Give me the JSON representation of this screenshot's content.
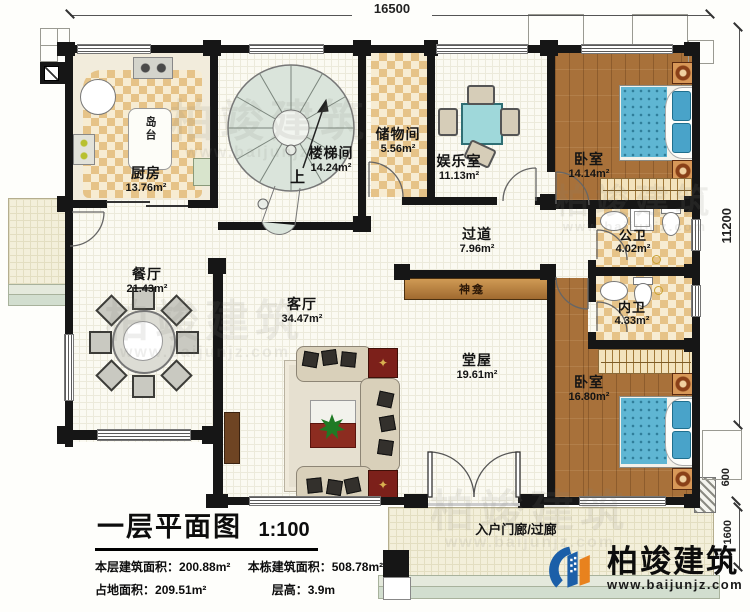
{
  "plan": {
    "dimensions": {
      "top_width": "16500",
      "right_height": "11200",
      "right_offset": "600",
      "porch_depth": "1600"
    },
    "rooms": [
      {
        "id": "kitchen",
        "name": "厨房",
        "area": "13.76m²"
      },
      {
        "id": "island",
        "name": "岛台",
        "area": ""
      },
      {
        "id": "stairwell",
        "name": "楼梯间",
        "area": "14.24m²",
        "up": "上"
      },
      {
        "id": "storage",
        "name": "储物间",
        "area": "5.56m²"
      },
      {
        "id": "entertainment",
        "name": "娱乐室",
        "area": "11.13m²"
      },
      {
        "id": "bedroom1",
        "name": "卧室",
        "area": "14.14m²"
      },
      {
        "id": "public-bath",
        "name": "公卫",
        "area": "4.02m²"
      },
      {
        "id": "hallway",
        "name": "过道",
        "area": "7.96m²"
      },
      {
        "id": "shrine",
        "name": "神龛",
        "area": ""
      },
      {
        "id": "ensuite-bath",
        "name": "内卫",
        "area": "4.33m²"
      },
      {
        "id": "dining",
        "name": "餐厅",
        "area": "21.43m²"
      },
      {
        "id": "living",
        "name": "客厅",
        "area": "34.47m²"
      },
      {
        "id": "main-hall",
        "name": "堂屋",
        "area": "19.61m²"
      },
      {
        "id": "bedroom2",
        "name": "卧室",
        "area": "16.80m²"
      },
      {
        "id": "porch",
        "name": "入户门廊/过廊",
        "area": ""
      }
    ]
  },
  "title_block": {
    "title": "一层平面图",
    "scale": "1:100",
    "stat1_label": "本层建筑面积：",
    "stat1_value": "200.88m²",
    "stat2_label": "本栋建筑面积：",
    "stat2_value": "508.78m²",
    "stat3_label": "占地面积：",
    "stat3_value": "209.51m²",
    "stat4_label": "层高：",
    "stat4_value": "3.9m"
  },
  "branding": {
    "company": "柏竣建筑",
    "website": "www.baijunjz.com"
  },
  "colors": {
    "wall": "#161616",
    "wood_floor": "#a8713a",
    "checker_tile": "#e6c388",
    "bed_blue": "#5fb6d3",
    "logo_blue": "#1b5fa8",
    "logo_orange": "#e8821e"
  }
}
